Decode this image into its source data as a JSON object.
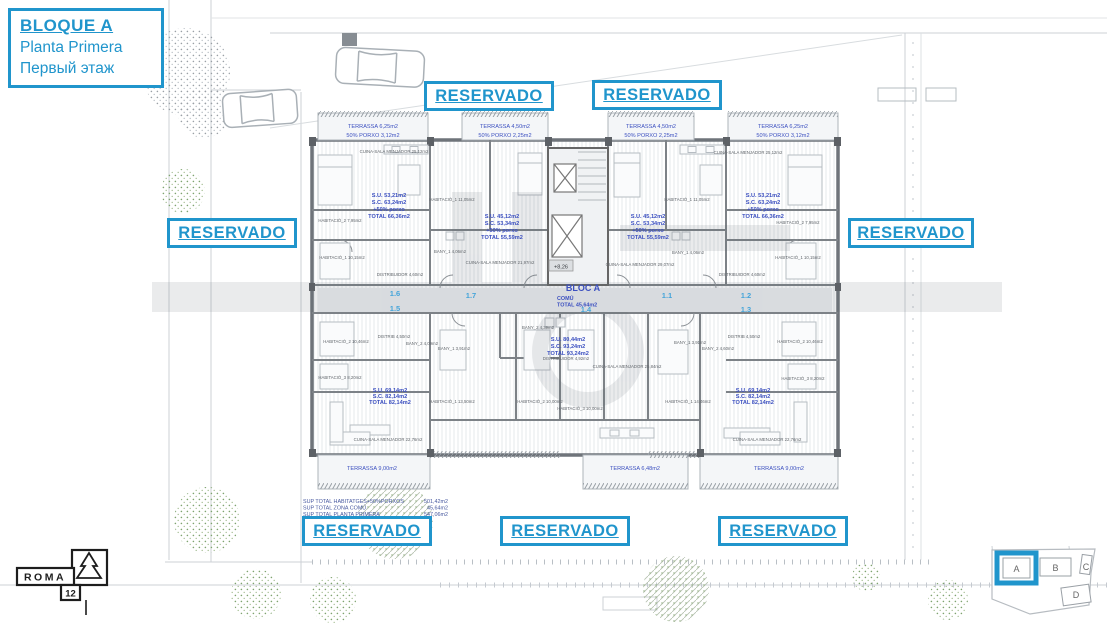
{
  "header": {
    "block_title": "BLOQUE A",
    "subtitle_es": "Planta Primera",
    "subtitle_ru": "Первый этаж"
  },
  "reservado_label": "RESERVADO",
  "plan": {
    "bloc_label": "BLOC A",
    "comu_label": "COMÚ",
    "comu_total": "TOTAL 45,64m2",
    "level_marker": "+8,26",
    "unit_numbers": [
      "1.6",
      "1.5",
      "1.7",
      "1.4",
      "1.1",
      "1.2",
      "1.3"
    ],
    "terraces": [
      {
        "line1": "TERRASSA 6,25m2",
        "line2": "50% PORXO 3,12m2"
      },
      {
        "line1": "TERRASSA 4,50m2",
        "line2": "50% PORXO 2,25m2"
      },
      {
        "line1": "TERRASSA 4,50m2",
        "line2": "50% PORXO 2,25m2"
      },
      {
        "line1": "TERRASSA 6,25m2",
        "line2": "50% PORXO 3,12m2"
      },
      {
        "line1": "TERRASSA 9,00m2",
        "line2": ""
      },
      {
        "line1": "TERRASSA 6,48m2",
        "line2": ""
      },
      {
        "line1": "TERRASSA 9,00m2",
        "line2": ""
      }
    ],
    "unit_stats": [
      {
        "lines": [
          "S.U. 53,21m2",
          "S.C. 63,24m2",
          "+50% porxo",
          "TOTAL 66,36m2"
        ]
      },
      {
        "lines": [
          "S.U. 45,12m2",
          "S.C. 53,34m2",
          "+50% porxo",
          "TOTAL 55,59m2"
        ]
      },
      {
        "lines": [
          "S.U. 45,12m2",
          "S.C. 53,34m2",
          "+50% porxo",
          "TOTAL 55,59m2"
        ]
      },
      {
        "lines": [
          "S.U. 53,21m2",
          "S.C. 63,24m2",
          "+50% porxo",
          "TOTAL 66,36m2"
        ]
      },
      {
        "lines": [
          "S.U. 69,14m2",
          "S.C. 82,14m2",
          "TOTAL 82,14m2"
        ]
      },
      {
        "lines": [
          "S.U. 80,44m2",
          "S.C. 93,24m2",
          "TOTAL 93,24m2"
        ]
      },
      {
        "lines": [
          "S.U. 69,14m2",
          "S.C. 82,14m2",
          "TOTAL 82,14m2"
        ]
      }
    ],
    "rooms": [
      "CUINA-SALA MENJADOR 25,12m2",
      "HABITACIÓ_1 11,05m2",
      "HABITACIÓ_2 7,95m2",
      "HABITACIÓ_1 10,15m2",
      "DISTRIBUIDOR 4,60m2",
      "BANY_1 4,06m2",
      "CUINA-SALA MENJADOR 21,97m2",
      "CUINA-SALA MENJADOR 29,07m2",
      "HABITACIÓ_1 11,05m2",
      "HABITACIÓ_2 7,95m2",
      "HABITACIÓ_1 10,15m2",
      "CUINA-SALA MENJADOR 25,12m2",
      "BANY_1 4,06m2",
      "DISTRIBUIDOR 4,60m2",
      "HABITACIÓ_2 10,46m2",
      "DISTRIB 4,50m2",
      "BANY_2 4,09m2",
      "BANY_1 3,91m2",
      "HABITACIÓ_3 8,20m2",
      "CUINA-SALA MENJADOR 22,76m2",
      "HABITACIÓ_1 13,50m2",
      "HABITACIÓ_2 10,00m2",
      "HABITACIÓ_3 10,00m2",
      "HABITACIÓ_1 14,46m2",
      "HABITACIÓ_2 10,46m2",
      "HABITACIÓ_3 8,20m2",
      "CUINA-SALA MENJADOR 22,76m2",
      "DISTRIB 4,50m2",
      "BANY_1 3,91m2",
      "BANY_2 4,60m2",
      "DISTRIBUIDOR 4,92m2",
      "CUINA-SALA MENJADOR 25,84m2",
      "BANY_2 4,39m2"
    ],
    "totals": [
      {
        "label": "SUP TOTAL HABITATGES+50%PORXOS",
        "value": "501,42m2"
      },
      {
        "label": "SUP TOTAL ZONA COMÚ",
        "value": "45,64m2"
      },
      {
        "label": "SUP TOTAL PLANTA PRIMERA",
        "value": "547,06m2"
      }
    ]
  },
  "logo": {
    "name": "ROMA",
    "number": "12"
  },
  "block_selector": {
    "blocks": [
      "A",
      "B",
      "C",
      "D"
    ],
    "selected": "A"
  },
  "colors": {
    "accent_blue": "#2095cc",
    "stat_blue": "#3c50c0",
    "unit_blue": "#44a4da"
  }
}
